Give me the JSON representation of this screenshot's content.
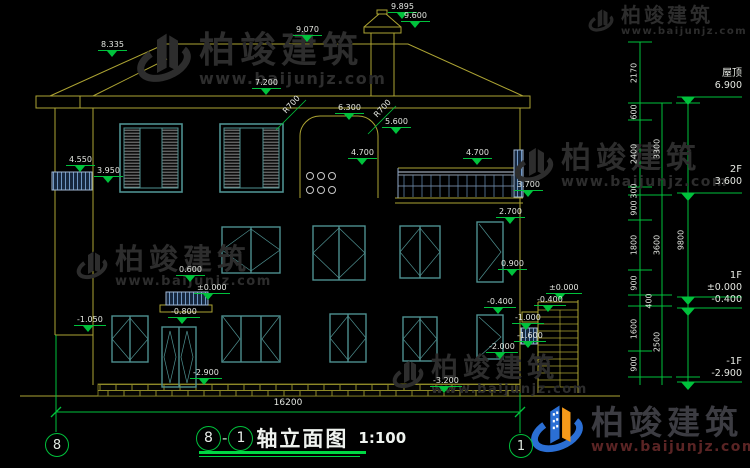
{
  "title": {
    "axis_left": "8",
    "axis_right": "1",
    "separator": "-",
    "text": "轴立面图",
    "scale": "1:100"
  },
  "axes": {
    "left_bubble": "8",
    "right_bubble": "1"
  },
  "watermark": {
    "brand": "柏竣建筑",
    "url": "www.baijunjz.com"
  },
  "bottom_dimension": "16200",
  "floor_marks": [
    {
      "name": "屋顶",
      "value": "6.900"
    },
    {
      "name": "2F",
      "value": "3.600"
    },
    {
      "name": "1F",
      "value": "±0.000",
      "value2": "-0.400"
    },
    {
      "name": "-1F",
      "value": "-2.900"
    }
  ],
  "annotations": [
    {
      "t": "9.895",
      "x": 388,
      "y": 2
    },
    {
      "t": "9.600",
      "x": 401,
      "y": 11
    },
    {
      "t": "9.070",
      "x": 293,
      "y": 25
    },
    {
      "t": "8.335",
      "x": 98,
      "y": 40
    },
    {
      "t": "7.200",
      "x": 252,
      "y": 78
    },
    {
      "t": "6.300",
      "x": 335,
      "y": 103
    },
    {
      "t": "5.600",
      "x": 382,
      "y": 117
    },
    {
      "t": "4.700",
      "x": 348,
      "y": 148
    },
    {
      "t": "4.700",
      "x": 463,
      "y": 148
    },
    {
      "t": "4.550",
      "x": 66,
      "y": 155
    },
    {
      "t": "3.950",
      "x": 94,
      "y": 166
    },
    {
      "t": "3.700",
      "x": 514,
      "y": 180
    },
    {
      "t": "2.700",
      "x": 496,
      "y": 207
    },
    {
      "t": "0.900",
      "x": 498,
      "y": 259
    },
    {
      "t": "0.600",
      "x": 176,
      "y": 265
    },
    {
      "t": "±0.000",
      "x": 194,
      "y": 283
    },
    {
      "t": "-0.800",
      "x": 168,
      "y": 307
    },
    {
      "t": "-1.050",
      "x": 74,
      "y": 315
    },
    {
      "t": "-2.900",
      "x": 190,
      "y": 368
    },
    {
      "t": "-0.400",
      "x": 484,
      "y": 297
    },
    {
      "t": "±0.000",
      "x": 546,
      "y": 283
    },
    {
      "t": "-0.400",
      "x": 534,
      "y": 295
    },
    {
      "t": "-1.000",
      "x": 512,
      "y": 313
    },
    {
      "t": "-1.600",
      "x": 514,
      "y": 331
    },
    {
      "t": "-2.000",
      "x": 486,
      "y": 342
    },
    {
      "t": "-3.200",
      "x": 430,
      "y": 376
    },
    {
      "t": "R700",
      "x": 281,
      "y": 100,
      "cls": "r45",
      "name": "radius-label"
    },
    {
      "t": "R700",
      "x": 372,
      "y": 104,
      "cls": "r45",
      "name": "radius-label"
    },
    {
      "t": "2170",
      "x": 634,
      "y": 73,
      "cls": "rot",
      "name": "dimension-label"
    },
    {
      "t": "600",
      "x": 634,
      "y": 112,
      "cls": "rot",
      "name": "dimension-label"
    },
    {
      "t": "2400",
      "x": 634,
      "y": 154,
      "cls": "rot",
      "name": "dimension-label"
    },
    {
      "t": "300",
      "x": 634,
      "y": 191,
      "cls": "rot",
      "name": "dimension-label"
    },
    {
      "t": "900",
      "x": 634,
      "y": 208,
      "cls": "rot",
      "name": "dimension-label"
    },
    {
      "t": "1800",
      "x": 634,
      "y": 245,
      "cls": "rot",
      "name": "dimension-label"
    },
    {
      "t": "900",
      "x": 634,
      "y": 283,
      "cls": "rot",
      "name": "dimension-label"
    },
    {
      "t": "400",
      "x": 649,
      "y": 301,
      "cls": "rot",
      "name": "dimension-label"
    },
    {
      "t": "1600",
      "x": 634,
      "y": 329,
      "cls": "rot",
      "name": "dimension-label"
    },
    {
      "t": "900",
      "x": 634,
      "y": 364,
      "cls": "rot",
      "name": "dimension-label"
    },
    {
      "t": "3300",
      "x": 657,
      "y": 149,
      "cls": "rot",
      "name": "dimension-label"
    },
    {
      "t": "3600",
      "x": 657,
      "y": 245,
      "cls": "rot",
      "name": "dimension-label"
    },
    {
      "t": "2500",
      "x": 657,
      "y": 342,
      "cls": "rot",
      "name": "dimension-label"
    },
    {
      "t": "9800",
      "x": 681,
      "y": 240,
      "cls": "rot",
      "name": "dimension-label"
    }
  ]
}
